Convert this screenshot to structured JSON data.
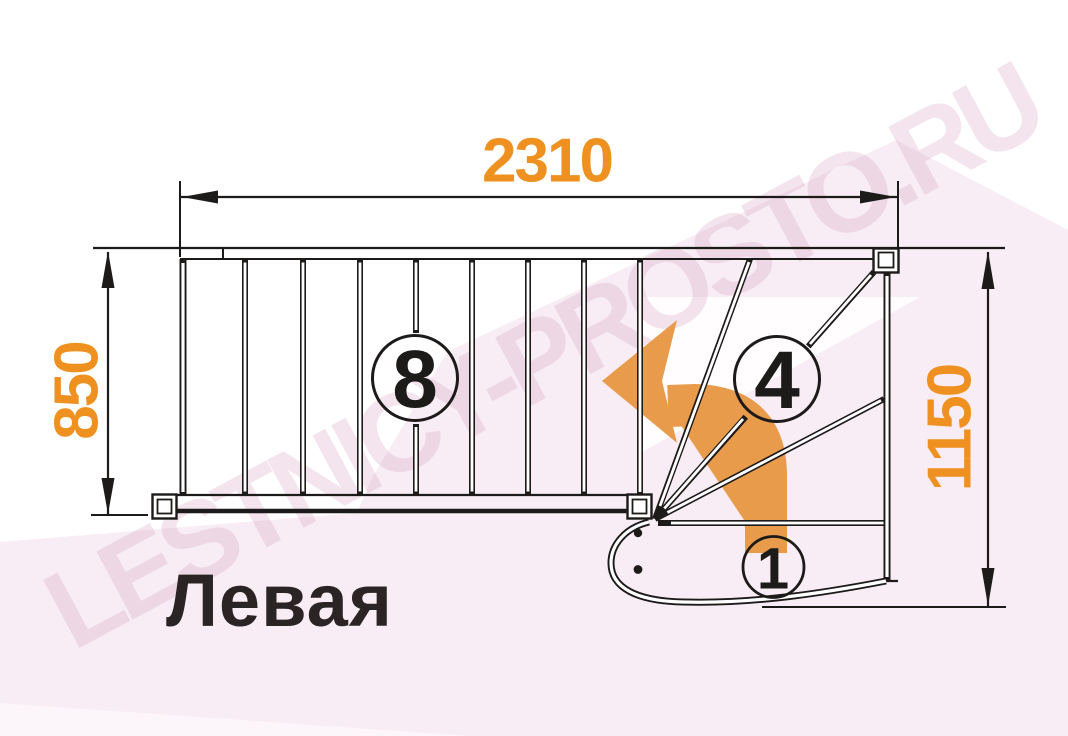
{
  "diagram": {
    "title": "Левая",
    "watermark": "LESTNICY-PROSTO.RU",
    "dimensions": {
      "top": "2310",
      "left": "850",
      "right": "1150"
    },
    "labels": {
      "straight_flight": "8",
      "winder": "4",
      "first_step": "1"
    },
    "colors": {
      "dimension_text": "#ee9121",
      "arrow": "#e99b4c",
      "line": "#1d1b1a",
      "background_pink": "#f8edf4",
      "title_text": "#2a2425",
      "watermark_text": "#d5a0c0"
    }
  }
}
